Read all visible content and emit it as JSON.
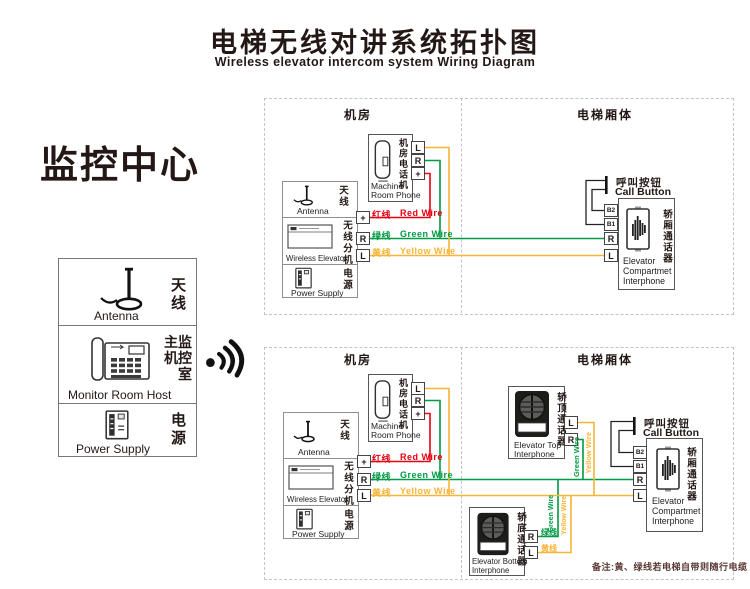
{
  "header": {
    "title_zh": "电梯无线对讲系统拓扑图",
    "title_en": "Wireless elevator intercom system Wiring Diagram"
  },
  "monitoring_center": {
    "heading": "监控中心",
    "antenna": {
      "zh": "天线",
      "en": "Antenna"
    },
    "host": {
      "zh_line1": "主监",
      "zh_line2": "机控",
      "zh_line3": "室",
      "en": "Monitor Room Host"
    },
    "power": {
      "zh": "电源",
      "en": "Power Supply"
    }
  },
  "zones": {
    "machine_room": "机房",
    "elevator_car": "电梯厢体"
  },
  "unit": {
    "antenna": {
      "zh": "天线",
      "en": "Antenna"
    },
    "wireless": {
      "zh": "无线分机",
      "en": "Wireless Elevator"
    },
    "power": {
      "zh": "电源",
      "en": "Power Supply"
    },
    "terminals": [
      "+",
      "R",
      "L"
    ]
  },
  "machine_room_phone": {
    "zh": "机房电话机",
    "en_line1": "Machine",
    "en_line2": "Room Phone",
    "terminals": [
      "L",
      "R",
      "+"
    ]
  },
  "wires": {
    "red": {
      "zh": "红线",
      "en": "Red Wire",
      "color": "#e60012"
    },
    "green": {
      "zh": "绿线",
      "en": "Green Wire",
      "color": "#009944"
    },
    "yellow": {
      "zh": "黄线",
      "en": "Yellow Wire",
      "color": "#f8b435"
    }
  },
  "call_button": {
    "zh": "呼叫按钮",
    "en": "Call Button"
  },
  "compartment_interphone": {
    "zh": "轿厢通话器",
    "en_line1": "Elevator",
    "en_line2": "Compartmet",
    "en_line3": "Interphone",
    "terminals": [
      "B2",
      "B1",
      "R",
      "L"
    ]
  },
  "top_interphone": {
    "zh": "轿顶通话器",
    "en_line1": "Elevator Top",
    "en_line2": "Interphone",
    "terminals": [
      "L",
      "R"
    ]
  },
  "bottom_interphone": {
    "zh": "轿底通话器",
    "en_line1": "Elevator Bottom",
    "en_line2": "Interphone",
    "terminals": [
      "R",
      "L"
    ],
    "green_tag": "绿线",
    "yellow_tag": "黄线"
  },
  "note": "备注:黄、绿线若电梯自带则随行电缆"
}
